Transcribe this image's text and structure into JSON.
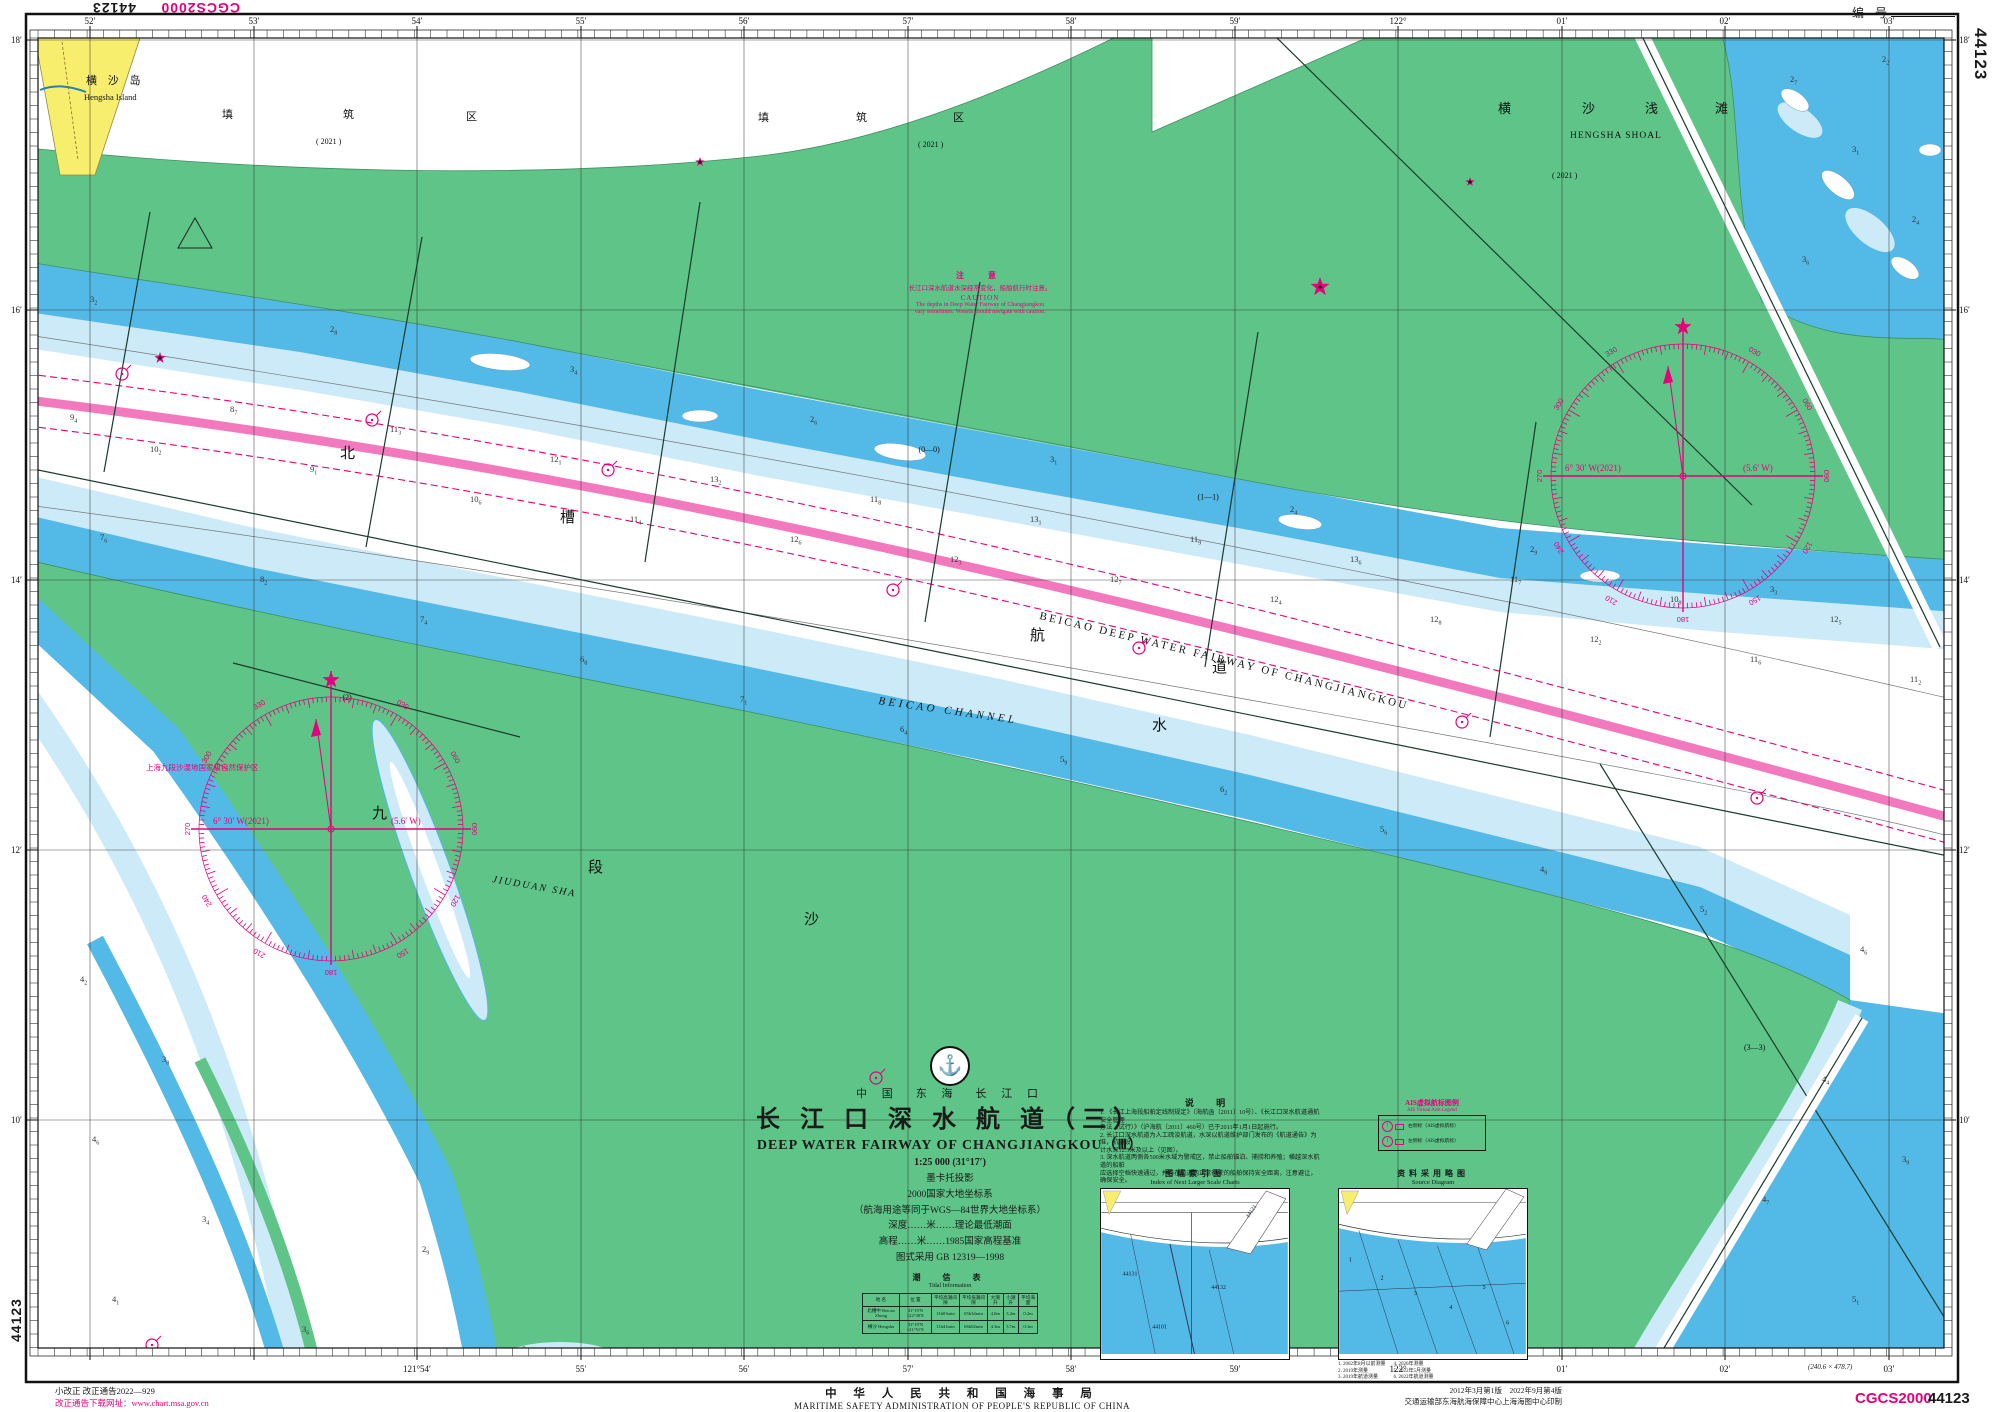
{
  "chart": {
    "number": "44123",
    "datum": "CGCS2000",
    "serial_label": "编  号",
    "correction1": "小改正 改正通告2022—929",
    "correction2": "改正通告下载网址：www.chart.msa.gov.cn",
    "authority_cn": "中 华 人 民 共 和 国 海 事 局",
    "authority_en": "MARITIME SAFETY ADMINISTRATION OF PEOPLE'S REPUBLIC OF CHINA",
    "edition1": "2012年3月第1版　2022年9月第4版",
    "edition2": "交通运输部东海航海保障中心上海海图中心印制",
    "dimensions": "(240.6 × 478.7)"
  },
  "title_block": {
    "logo_glyph": "⚓",
    "region": "中 国　东 海　长 江 口",
    "title_cn": "长 江 口 深 水 航 道（三）",
    "title_en": "DEEP  WATER  FAIRWAY  OF  CHANGJIANGKOU（Ⅲ）",
    "scale": "1:25 000 (31°17′)",
    "projection": "墨卡托投影",
    "datum1": "2000国家大地坐标系",
    "datum2": "（航海用途等同于WGS—84世界大地坐标系）",
    "depth_note": "深度……米……理论最低潮面",
    "height_note": "高程……米……1985国家高程基准",
    "symbols_note": "图式采用 GB 12319—1998"
  },
  "tide_table": {
    "title_cn": "潮　信　表",
    "title_en": "Tidal  Information",
    "headers": [
      "地  名",
      "位      置",
      "平均高潮间隙",
      "平均低潮间隙",
      "大潮升",
      "小潮升",
      "平均海面"
    ],
    "rows": [
      [
        "北槽中 Beicao Zhong",
        "31°19′N 122°30′E",
        "11h03min",
        "05h34min",
        "4.0m",
        "3.2m",
        "0.2m"
      ],
      [
        "横沙 Hengsha",
        "31°19′N 121°51′E",
        "11h41min",
        "06h02min",
        "4.3m",
        "3.7m",
        "0.1m"
      ]
    ]
  },
  "notes": {
    "title": "说    明",
    "lines": [
      "1. 《长江上海段船舶定线制规定》（海航函〔2011〕10号）、《长江口深水航道通航安全管理",
      "办法（试行）》（沪海航〔2011〕460号）已于2011年1月1日起施行。",
      "2. 长江口深水航道为人工疏浚航道，水深以航道维护部门发布的《航道通告》为准，航道设",
      "计水深12.5米及以上（见图）。",
      "3. 深水航道两侧各500米水域为警戒区，禁止船舶锚泊、捕捞和养殖；横越深水航道的船舶",
      "应选择空档快速通过，并与在航道内正常行驶的船舶保持安全距离，注意避让，确保安全。"
    ]
  },
  "caution": {
    "title_cn": "注　意",
    "body_cn": "长江口深水航道水深经常变化，船舶航行时注意。",
    "title_en": "CAUTION",
    "body_en1": "The depths in Deep Water Fairway of Changjiangkou",
    "body_en2": "vary sometimes. Vessels should navigate with caution."
  },
  "ais_legend": {
    "title_cn": "AIS虚拟航标图例",
    "title_en": "AIS Virtual Aids Legend",
    "rows": [
      "右侧标（AIS虚拟航标）",
      "左侧标（AIS虚拟航标）"
    ]
  },
  "index_chart": {
    "title_cn": "图幅索引图",
    "title_en": "Index of Next Larger Scale Charts",
    "labels": [
      "44131",
      "44132",
      "44121",
      "44101"
    ]
  },
  "source_diagram": {
    "title_cn": "资料采用略图",
    "title_en": "Source Diagram",
    "zones": [
      "1",
      "2",
      "3",
      "4",
      "5",
      "6"
    ],
    "footnotes_left": [
      "1. 2002年8月以前测量",
      "2. 2019年测量",
      "3. 2019年航道测量"
    ],
    "footnotes_right": [
      "4. 2020年测量",
      "5. 2022年5月测量",
      "6. 2022年航道测量"
    ]
  },
  "compass": {
    "variation": "6° 30′ W(2021)",
    "annual_change": "(5.6′ W)",
    "roses": [
      {
        "cx": 331,
        "cy": 829,
        "r": 132
      },
      {
        "cx": 1683,
        "cy": 476,
        "r": 132
      }
    ]
  },
  "graticule": {
    "meridian_x": [
      90,
      254,
      417,
      581,
      744,
      908,
      1071,
      1235,
      1398,
      1562,
      1725,
      1889
    ],
    "top_labels": [
      "52′",
      "53′",
      "54′",
      "55′",
      "56′",
      "57′",
      "58′",
      "59′",
      "122°",
      "01′",
      "02′",
      "03′"
    ],
    "bottom_labels": [
      "",
      "",
      "121°54′",
      "55′",
      "56′",
      "57′",
      "58′",
      "59′",
      "122°",
      "01′",
      "02′",
      "03′"
    ],
    "parallel_y": [
      40,
      310,
      580,
      850,
      1120
    ],
    "left_labels": [
      "18′",
      "16′",
      "14′",
      "12′",
      "10′"
    ],
    "right_labels": [
      "18′",
      "16′",
      "14′",
      "12′",
      "10′"
    ]
  },
  "map": {
    "fairway_label": "BEICAO  DEEP  WATER  FAIRWAY  OF  CHANGJIANGKOU",
    "channel_label_en": "BEICAO   CHANNEL"
  },
  "map_labels": [
    {
      "t": "横  沙  岛",
      "x": 86,
      "y": 84,
      "s": 11,
      "ls": 4
    },
    {
      "t": "Hengsha Island",
      "x": 84,
      "y": 100,
      "s": 8.5
    },
    {
      "t": "填",
      "x": 222,
      "y": 118,
      "s": 11
    },
    {
      "t": "筑",
      "x": 343,
      "y": 118,
      "s": 11
    },
    {
      "t": "区",
      "x": 466,
      "y": 120,
      "s": 11
    },
    {
      "t": "( 2021 )",
      "x": 316,
      "y": 144,
      "s": 8
    },
    {
      "t": "填",
      "x": 758,
      "y": 121,
      "s": 11
    },
    {
      "t": "筑",
      "x": 856,
      "y": 121,
      "s": 11
    },
    {
      "t": "区",
      "x": 953,
      "y": 121,
      "s": 11
    },
    {
      "t": "( 2021 )",
      "x": 918,
      "y": 147,
      "s": 8
    },
    {
      "t": "横",
      "x": 1498,
      "y": 113,
      "s": 13
    },
    {
      "t": "沙",
      "x": 1582,
      "y": 113,
      "s": 13
    },
    {
      "t": "浅",
      "x": 1645,
      "y": 113,
      "s": 13
    },
    {
      "t": "滩",
      "x": 1715,
      "y": 113,
      "s": 13
    },
    {
      "t": "HENGSHA SHOAL",
      "x": 1570,
      "y": 138,
      "s": 9.5,
      "ls": 1
    },
    {
      "t": "北",
      "x": 340,
      "y": 458,
      "s": 15
    },
    {
      "t": "槽",
      "x": 560,
      "y": 522,
      "s": 15
    },
    {
      "t": "航",
      "x": 1030,
      "y": 640,
      "s": 15
    },
    {
      "t": "道",
      "x": 1212,
      "y": 672,
      "s": 15
    },
    {
      "t": "水",
      "x": 1152,
      "y": 730,
      "s": 15
    },
    {
      "t": "九",
      "x": 372,
      "y": 818,
      "s": 15
    },
    {
      "t": "段",
      "x": 588,
      "y": 872,
      "s": 15
    },
    {
      "t": "沙",
      "x": 804,
      "y": 924,
      "s": 15
    },
    {
      "t": "JIUDUAN  SHA",
      "x": 492,
      "y": 882,
      "s": 10,
      "i": 1,
      "r": 10,
      "ls": 2
    },
    {
      "t": "上海九段沙湿地国家级自然保护区",
      "x": 146,
      "y": 770,
      "s": 7.5,
      "c": "#e5007d"
    },
    {
      "t": "( 2021 )",
      "x": 1552,
      "y": 178,
      "s": 8
    }
  ],
  "lines": [
    [
      150,
      212,
      104,
      472,
      "",
      0
    ],
    [
      422,
      237,
      366,
      547,
      "",
      0
    ],
    [
      700,
      202,
      645,
      562,
      "",
      0
    ],
    [
      980,
      282,
      925,
      622,
      "(0—0)",
      0
    ],
    [
      1258,
      332,
      1205,
      667,
      "(1—1)",
      0
    ],
    [
      1536,
      422,
      1490,
      737,
      "",
      0
    ],
    [
      28,
      468,
      1958,
      858,
      "",
      0
    ],
    [
      1276,
      37,
      1752,
      505,
      "",
      0
    ],
    [
      1640,
      32,
      1940,
      647,
      "",
      1
    ],
    [
      1600,
      764,
      1956,
      1336,
      "(3—3)",
      0
    ],
    [
      1862,
      1018,
      1640,
      1388,
      "",
      1
    ],
    [
      233,
      663,
      520,
      737,
      "(2)",
      0
    ]
  ],
  "buoys": [
    [
      122,
      374
    ],
    [
      372,
      420
    ],
    [
      608,
      470
    ],
    [
      893,
      590
    ],
    [
      1139,
      648
    ],
    [
      1462,
      722
    ],
    [
      1757,
      798
    ],
    [
      876,
      1078
    ],
    [
      152,
      1345
    ]
  ],
  "beacons": [
    [
      160,
      358,
      6
    ],
    [
      1320,
      287,
      10
    ],
    [
      700,
      162,
      5
    ],
    [
      1470,
      182,
      5
    ]
  ],
  "soundings": [
    [
      70,
      420,
      "9",
      "4"
    ],
    [
      150,
      452,
      "10",
      "2"
    ],
    [
      230,
      412,
      "8",
      "7"
    ],
    [
      310,
      472,
      "9",
      "1"
    ],
    [
      390,
      432,
      "11",
      "3"
    ],
    [
      470,
      502,
      "10",
      "6"
    ],
    [
      550,
      462,
      "12",
      "1"
    ],
    [
      630,
      522,
      "11",
      "4"
    ],
    [
      710,
      482,
      "13",
      "2"
    ],
    [
      790,
      542,
      "12",
      "6"
    ],
    [
      870,
      502,
      "11",
      "8"
    ],
    [
      950,
      562,
      "12",
      "3"
    ],
    [
      1030,
      522,
      "13",
      "1"
    ],
    [
      1110,
      582,
      "12",
      "7"
    ],
    [
      1190,
      542,
      "11",
      "9"
    ],
    [
      1270,
      602,
      "12",
      "4"
    ],
    [
      1350,
      562,
      "13",
      "6"
    ],
    [
      1430,
      622,
      "12",
      "8"
    ],
    [
      1510,
      582,
      "11",
      "7"
    ],
    [
      1590,
      642,
      "12",
      "2"
    ],
    [
      1670,
      602,
      "10",
      "9"
    ],
    [
      1750,
      662,
      "11",
      "6"
    ],
    [
      1830,
      622,
      "12",
      "5"
    ],
    [
      1910,
      682,
      "11",
      "2"
    ],
    [
      100,
      540,
      "7",
      "6"
    ],
    [
      260,
      582,
      "8",
      "2"
    ],
    [
      420,
      622,
      "7",
      "4"
    ],
    [
      580,
      662,
      "6",
      "8"
    ],
    [
      740,
      702,
      "7",
      "1"
    ],
    [
      900,
      732,
      "6",
      "4"
    ],
    [
      1060,
      762,
      "5",
      "9"
    ],
    [
      1220,
      792,
      "6",
      "2"
    ],
    [
      1380,
      832,
      "5",
      "6"
    ],
    [
      1540,
      872,
      "4",
      "9"
    ],
    [
      1700,
      912,
      "5",
      "2"
    ],
    [
      1860,
      952,
      "4",
      "6"
    ],
    [
      90,
      302,
      "3",
      "2"
    ],
    [
      330,
      332,
      "2",
      "8"
    ],
    [
      570,
      372,
      "3",
      "4"
    ],
    [
      810,
      422,
      "2",
      "6"
    ],
    [
      1050,
      462,
      "3",
      "1"
    ],
    [
      1290,
      512,
      "2",
      "4"
    ],
    [
      1530,
      552,
      "2",
      "9"
    ],
    [
      1770,
      592,
      "3",
      "3"
    ],
    [
      1790,
      82,
      "2",
      "7"
    ],
    [
      1852,
      152,
      "3",
      "1"
    ],
    [
      1912,
      222,
      "2",
      "4"
    ],
    [
      1802,
      262,
      "3",
      "6"
    ],
    [
      1882,
      62,
      "2",
      "2"
    ],
    [
      80,
      982,
      "4",
      "2"
    ],
    [
      162,
      1062,
      "3",
      "8"
    ],
    [
      92,
      1142,
      "4",
      "6"
    ],
    [
      202,
      1222,
      "3",
      "4"
    ],
    [
      112,
      1302,
      "4",
      "1"
    ],
    [
      302,
      1332,
      "3",
      "6"
    ],
    [
      422,
      1252,
      "2",
      "9"
    ],
    [
      522,
      1352,
      "3",
      "2"
    ],
    [
      1822,
      1082,
      "4",
      "4"
    ],
    [
      1902,
      1162,
      "3",
      "9"
    ],
    [
      1762,
      1202,
      "4",
      "7"
    ],
    [
      1852,
      1302,
      "5",
      "1"
    ],
    [
      1922,
      1362,
      "4",
      "3"
    ]
  ]
}
